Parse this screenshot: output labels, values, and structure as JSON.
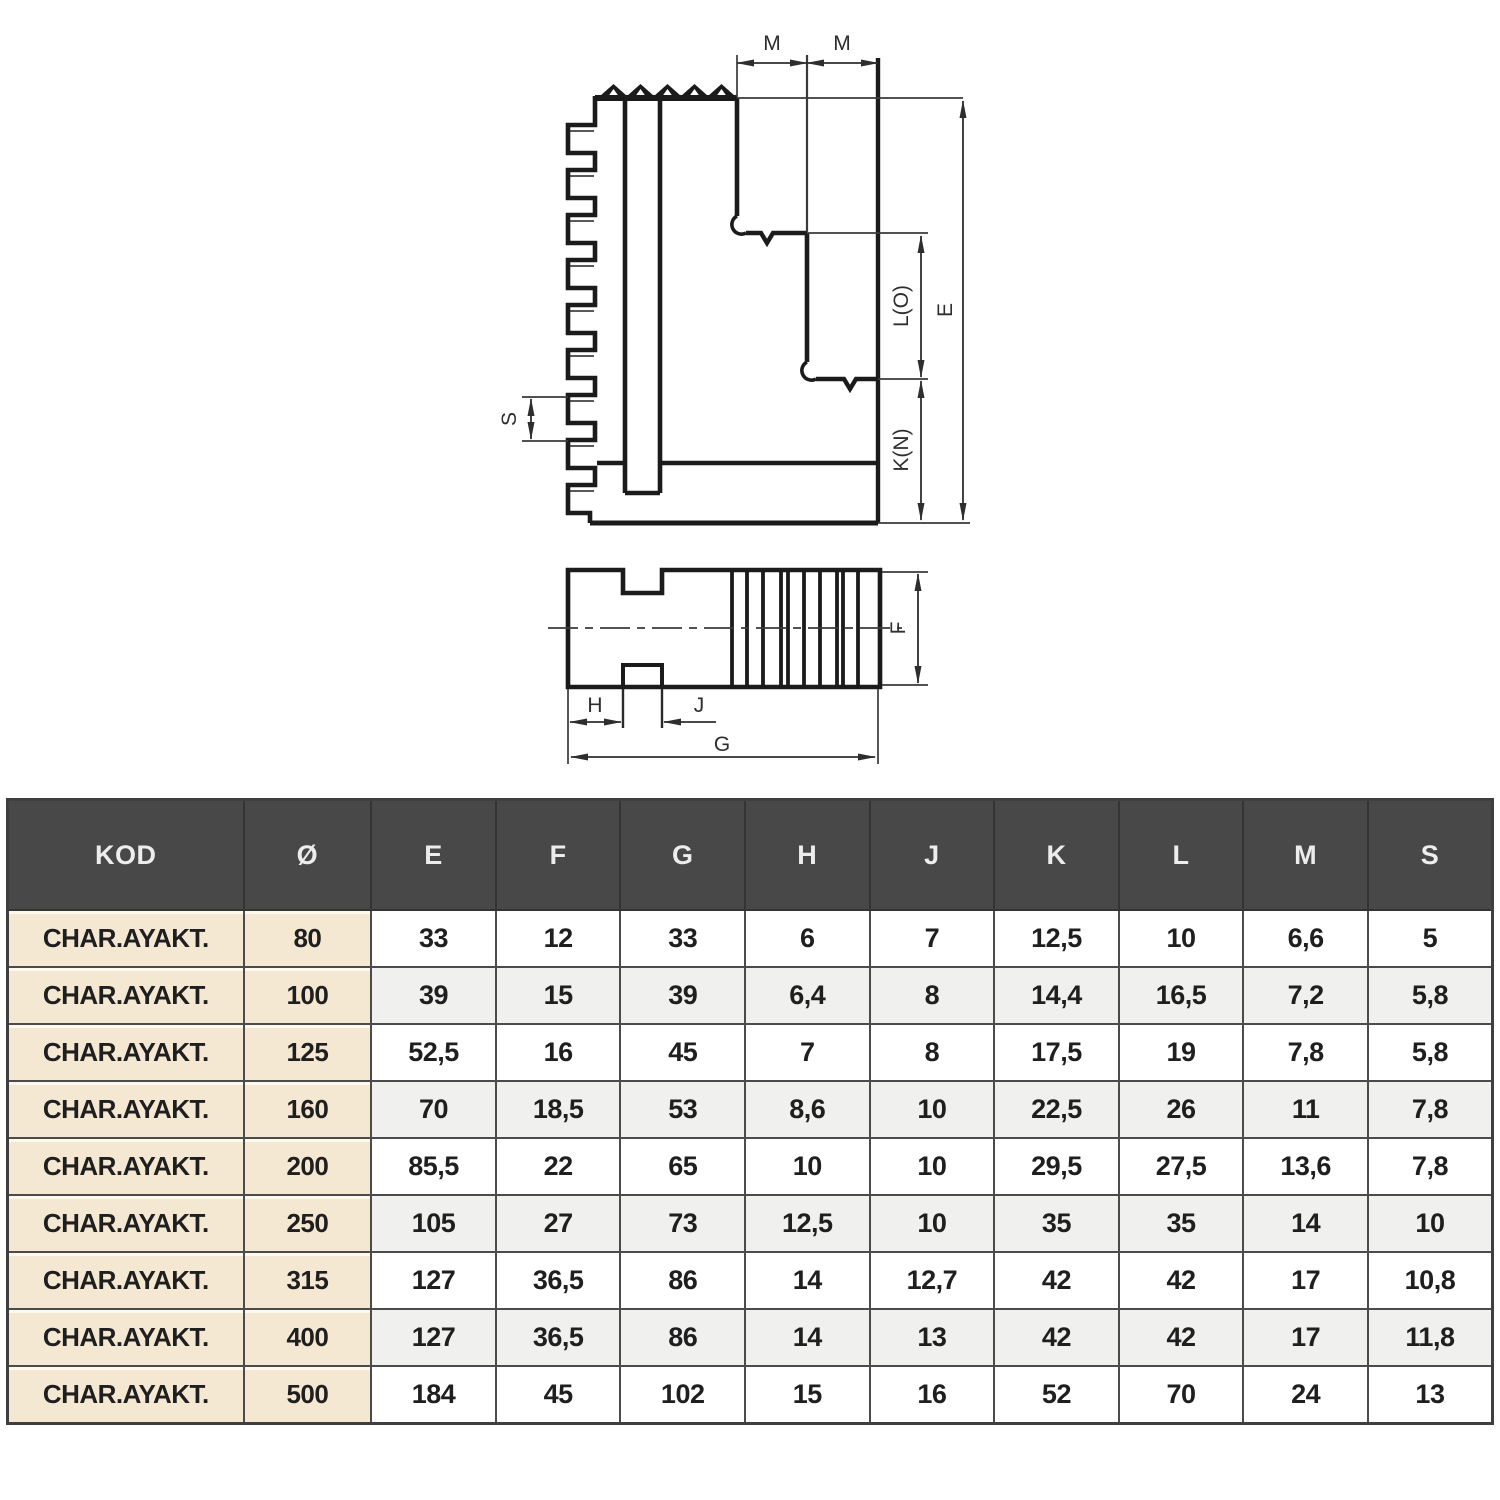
{
  "drawing": {
    "labels": {
      "m_left": "M",
      "m_right": "M",
      "e": "E",
      "lo": "L(O)",
      "kn": "K(N)",
      "s": "S",
      "h": "H",
      "j": "J",
      "g": "G",
      "f": "F"
    },
    "line_color": "#1b1b1b",
    "dim_color": "#3a3a3a"
  },
  "table": {
    "columns": [
      "KOD",
      "Ø",
      "E",
      "F",
      "G",
      "H",
      "J",
      "K",
      "L",
      "M",
      "S"
    ],
    "rows": [
      [
        "CHAR.AYAKT.",
        "80",
        "33",
        "12",
        "33",
        "6",
        "7",
        "12,5",
        "10",
        "6,6",
        "5"
      ],
      [
        "CHAR.AYAKT.",
        "100",
        "39",
        "15",
        "39",
        "6,4",
        "8",
        "14,4",
        "16,5",
        "7,2",
        "5,8"
      ],
      [
        "CHAR.AYAKT.",
        "125",
        "52,5",
        "16",
        "45",
        "7",
        "8",
        "17,5",
        "19",
        "7,8",
        "5,8"
      ],
      [
        "CHAR.AYAKT.",
        "160",
        "70",
        "18,5",
        "53",
        "8,6",
        "10",
        "22,5",
        "26",
        "11",
        "7,8"
      ],
      [
        "CHAR.AYAKT.",
        "200",
        "85,5",
        "22",
        "65",
        "10",
        "10",
        "29,5",
        "27,5",
        "13,6",
        "7,8"
      ],
      [
        "CHAR.AYAKT.",
        "250",
        "105",
        "27",
        "73",
        "12,5",
        "10",
        "35",
        "35",
        "14",
        "10"
      ],
      [
        "CHAR.AYAKT.",
        "315",
        "127",
        "36,5",
        "86",
        "14",
        "12,7",
        "42",
        "42",
        "17",
        "10,8"
      ],
      [
        "CHAR.AYAKT.",
        "400",
        "127",
        "36,5",
        "86",
        "14",
        "13",
        "42",
        "42",
        "17",
        "11,8"
      ],
      [
        "CHAR.AYAKT.",
        "500",
        "184",
        "45",
        "102",
        "15",
        "16",
        "52",
        "70",
        "24",
        "13"
      ]
    ],
    "colors": {
      "header_bg": "#484848",
      "header_text": "#ededed",
      "kod_bg": "#f5e8d2",
      "alt_row_bg": "#f0f0ef",
      "border": "#4b4b4b"
    }
  }
}
